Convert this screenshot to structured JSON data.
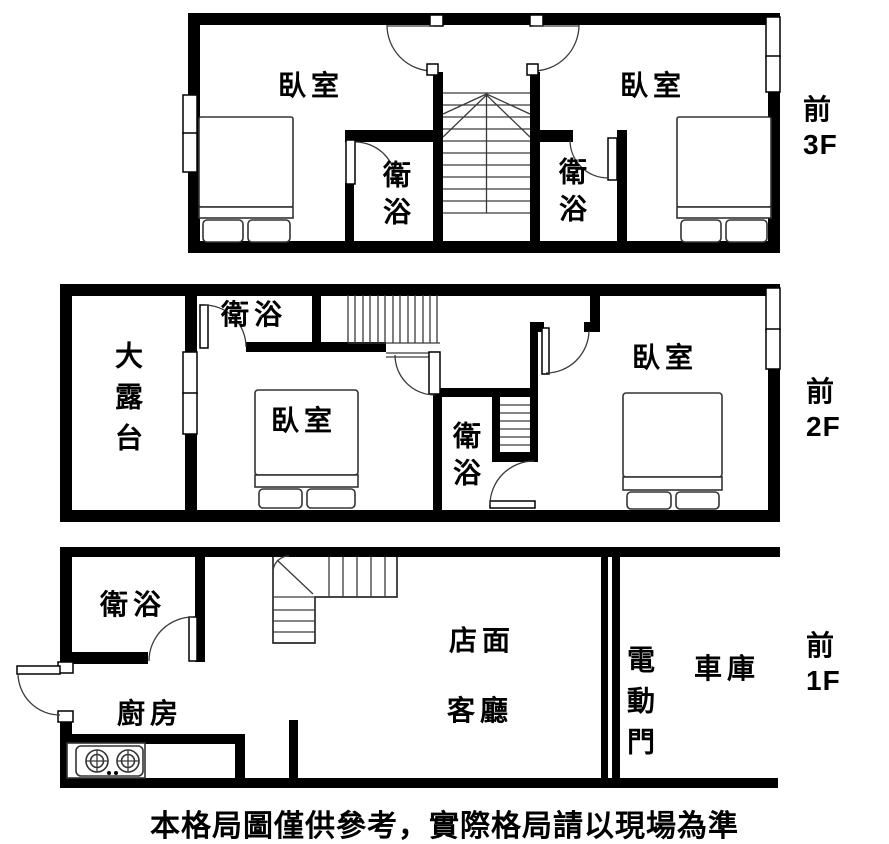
{
  "caption": "本格局圖僅供參考，實際格局請以現場為準",
  "colors": {
    "wall": "#000000",
    "line": "#2a2a2a",
    "background": "#ffffff"
  },
  "floors": [
    {
      "id": "3f",
      "side_label": {
        "direction": "前",
        "level": "3F"
      },
      "rooms": {
        "bedroom_left": "臥室",
        "bedroom_right": "臥室",
        "bath_left": "衛浴",
        "bath_right": "衛浴"
      }
    },
    {
      "id": "2f",
      "side_label": {
        "direction": "前",
        "level": "2F"
      },
      "rooms": {
        "terrace": "大露台",
        "bath_top": "衛浴",
        "bedroom_middle": "臥室",
        "bath_middle": "衛浴",
        "bedroom_right": "臥室"
      }
    },
    {
      "id": "1f",
      "side_label": {
        "direction": "前",
        "level": "1F"
      },
      "rooms": {
        "bath": "衛浴",
        "kitchen": "廚房",
        "storefront": "店面",
        "living_room": "客廳",
        "electric_door": "電動門",
        "garage": "車庫"
      }
    }
  ]
}
